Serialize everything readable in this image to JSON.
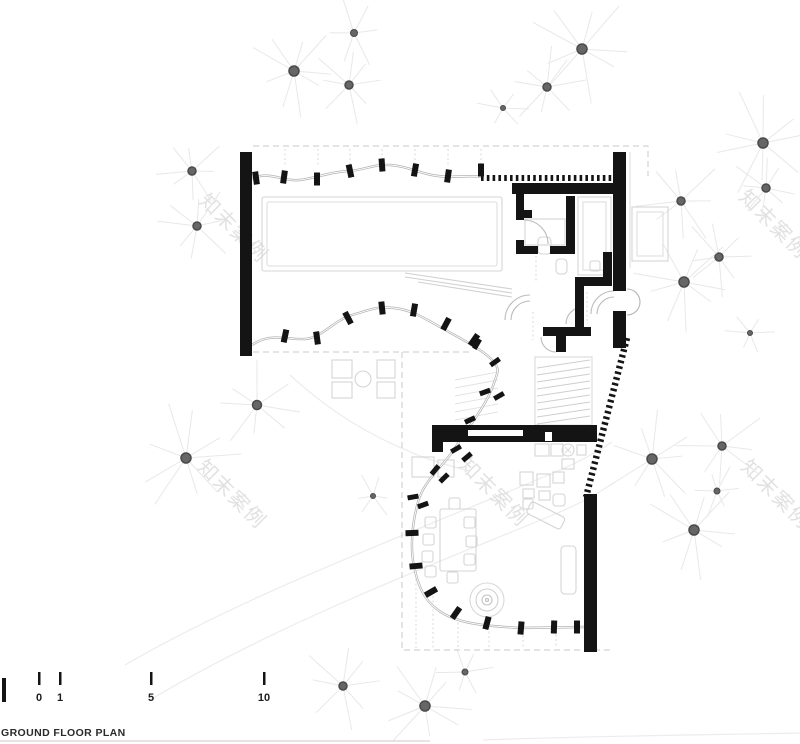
{
  "title": {
    "label": "GROUND FLOOR PLAN"
  },
  "scale_bar": {
    "labels": [
      "0",
      "1",
      "5",
      "10"
    ]
  },
  "watermark": {
    "text": "知末案例",
    "color": "#e1e1e1",
    "font_size": 20,
    "rotation_deg": 45,
    "positions": [
      {
        "x": 198,
        "y": 202
      },
      {
        "x": 738,
        "y": 198
      },
      {
        "x": 196,
        "y": 468
      },
      {
        "x": 740,
        "y": 468
      },
      {
        "x": 458,
        "y": 466
      }
    ]
  },
  "trees": {
    "dot_color": "#666666",
    "dot_edge_color": "#4a4a4a",
    "branch_color": "#e8e8e8",
    "items": [
      {
        "x": 354,
        "y": 33,
        "r": 3.5,
        "len": 36
      },
      {
        "x": 294,
        "y": 71,
        "r": 5,
        "len": 52
      },
      {
        "x": 349,
        "y": 85,
        "r": 4,
        "len": 42
      },
      {
        "x": 582,
        "y": 49,
        "r": 5,
        "len": 55
      },
      {
        "x": 547,
        "y": 87,
        "r": 4,
        "len": 45
      },
      {
        "x": 503,
        "y": 108,
        "r": 2.5,
        "len": 28
      },
      {
        "x": 763,
        "y": 143,
        "r": 5,
        "len": 55
      },
      {
        "x": 192,
        "y": 171,
        "r": 4,
        "len": 40
      },
      {
        "x": 197,
        "y": 226,
        "r": 4,
        "len": 42
      },
      {
        "x": 681,
        "y": 201,
        "r": 4,
        "len": 45
      },
      {
        "x": 766,
        "y": 188,
        "r": 4,
        "len": 40
      },
      {
        "x": 719,
        "y": 257,
        "r": 4,
        "len": 42
      },
      {
        "x": 684,
        "y": 282,
        "r": 5,
        "len": 50
      },
      {
        "x": 750,
        "y": 333,
        "r": 2.5,
        "len": 28
      },
      {
        "x": 257,
        "y": 405,
        "r": 4.5,
        "len": 46
      },
      {
        "x": 186,
        "y": 458,
        "r": 5,
        "len": 55
      },
      {
        "x": 373,
        "y": 496,
        "r": 2.5,
        "len": 26
      },
      {
        "x": 652,
        "y": 459,
        "r": 5,
        "len": 50
      },
      {
        "x": 722,
        "y": 446,
        "r": 4,
        "len": 45
      },
      {
        "x": 717,
        "y": 491,
        "r": 3,
        "len": 30
      },
      {
        "x": 694,
        "y": 530,
        "r": 5,
        "len": 52
      },
      {
        "x": 343,
        "y": 686,
        "r": 4,
        "len": 44
      },
      {
        "x": 425,
        "y": 706,
        "r": 5,
        "len": 52
      },
      {
        "x": 465,
        "y": 672,
        "r": 3,
        "len": 30
      }
    ]
  },
  "plan": {
    "colors": {
      "wall": "#141414",
      "glass_line": "#b3b3b3",
      "furniture_outline": "#d4d4d4",
      "dashed_boundary": "#c9c9c9",
      "site_contour": "#ececec",
      "background": "#ffffff"
    }
  }
}
